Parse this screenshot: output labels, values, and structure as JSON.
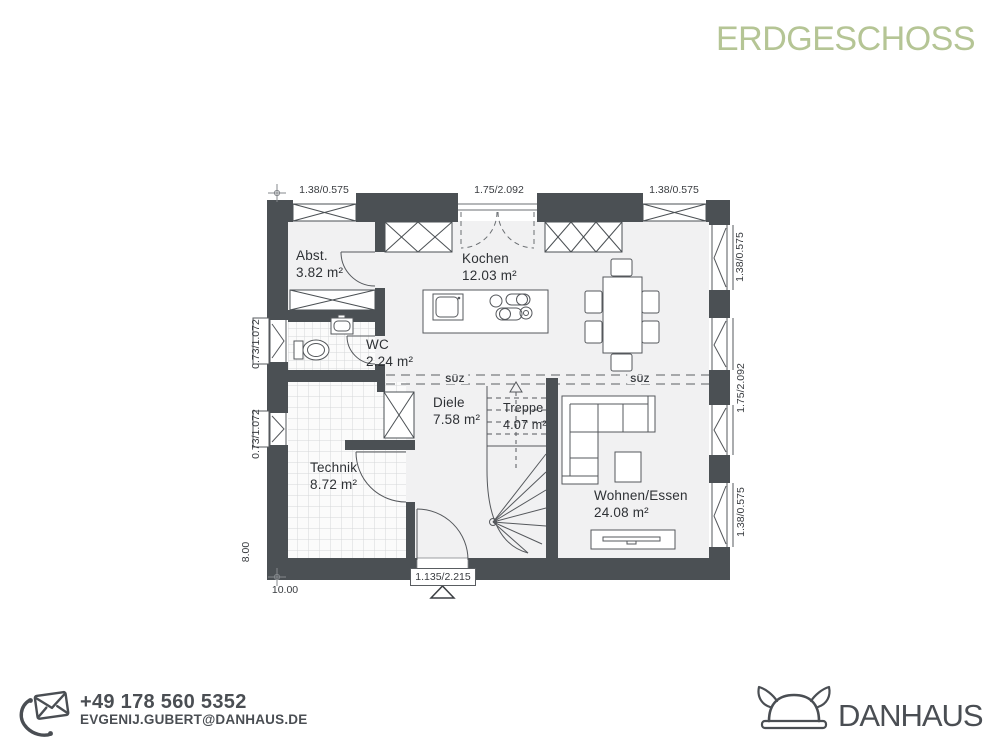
{
  "title": "ERDGESCHOSS",
  "plan": {
    "section_label": "SÜZ",
    "rooms": {
      "abst": {
        "name": "Abst.",
        "area": "3.82 m²"
      },
      "kochen": {
        "name": "Kochen",
        "area": "12.03 m²"
      },
      "wc": {
        "name": "WC",
        "area": "2.24 m²"
      },
      "diele": {
        "name": "Diele",
        "area": "7.58 m²"
      },
      "treppe": {
        "name": "Treppe",
        "area": "4.07 m²"
      },
      "technik": {
        "name": "Technik",
        "area": "8.72 m²"
      },
      "wohnen": {
        "name": "Wohnen/Essen",
        "area": "24.08 m²"
      }
    },
    "dimensions": {
      "top": [
        "1.38/0.575",
        "1.75/2.092",
        "1.38/0.575"
      ],
      "right": [
        "1.38/0.575",
        "1.75/2.092",
        "1.38/0.575"
      ],
      "left": [
        "0.73/1.072",
        "0.73/1.072"
      ],
      "width": "10.00",
      "height": "8.00",
      "entrance": "1.135/2.215"
    }
  },
  "contact": {
    "phone": "+49 178 560 5352",
    "email": "EVGENIJ.GUBERT@DANHAUS.DE"
  },
  "brand": {
    "name": "DANHAUS"
  },
  "colors": {
    "accent_green": "#b5c595",
    "wall": "#4b5054",
    "room_fill": "#f1f1f2",
    "text": "#2e3135",
    "brand_gray": "#4a4e53"
  }
}
